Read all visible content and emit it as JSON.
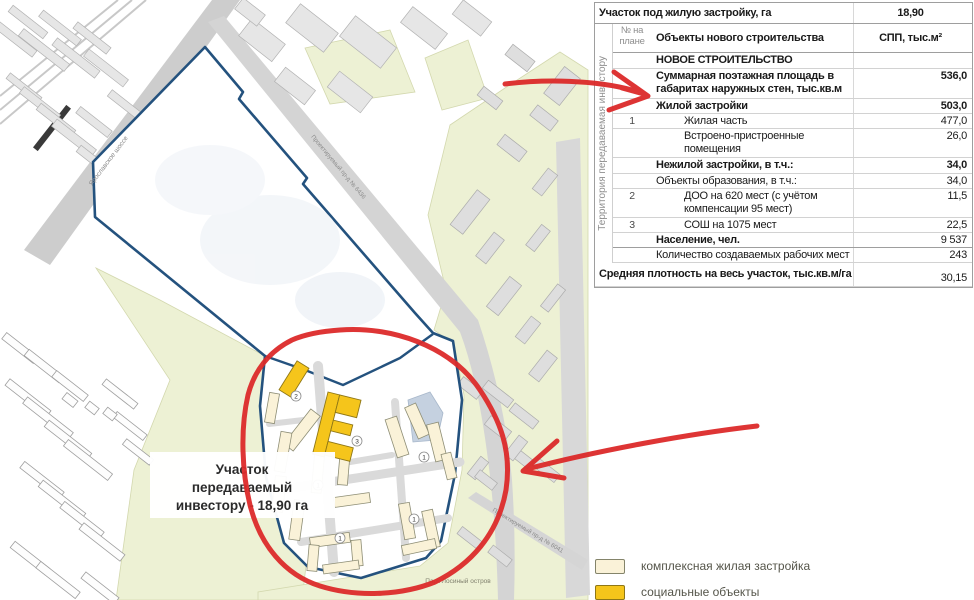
{
  "table": {
    "vertical_label": "Территория передаваемая инвестору",
    "rows": [
      {
        "num": "",
        "label": "Участок под жилую застройку, га",
        "value": "18,90",
        "bold": true,
        "vbold": true,
        "vcenter": true,
        "span": true,
        "hb": true
      },
      {
        "num": "№ на плане",
        "label": "Объекты нового строительства",
        "value": "СПП, тыс.м²",
        "bold": true,
        "vbold": true,
        "vcenter": true,
        "numgray": true,
        "hb": true
      },
      {
        "num": "",
        "label": "НОВОЕ СТРОИТЕЛЬСТВО",
        "value": "",
        "bold": true
      },
      {
        "num": "",
        "label": "Суммарная поэтажная площадь в габаритах наружных стен, тыс.кв.м",
        "value": "536,0",
        "bold": true,
        "vbold": true,
        "tall": true
      },
      {
        "num": "",
        "label": "Жилой застройки",
        "value": "503,0",
        "bold": true,
        "vbold": true
      },
      {
        "num": "1",
        "label": "Жилая часть",
        "value": "477,0",
        "indent": true
      },
      {
        "num": "",
        "label": "Встроено-пристроенные помещения",
        "value": "26,0",
        "indent": true,
        "tall": true
      },
      {
        "num": "",
        "label": "Нежилой застройки, в т.ч.:",
        "value": "34,0",
        "bold": true,
        "vbold": true
      },
      {
        "num": "",
        "label": "Объекты образования, в т.ч.:",
        "value": "34,0"
      },
      {
        "num": "2",
        "label": "ДОО на 620 мест (с учётом компенсации 95 мест)",
        "value": "11,5",
        "indent": true,
        "tall": true
      },
      {
        "num": "3",
        "label": "СОШ на 1075 мест",
        "value": "22,5",
        "indent": true
      },
      {
        "num": "",
        "label": "Население, чел.",
        "value": "9 537",
        "bold": true,
        "hb": true
      },
      {
        "num": "",
        "label": "Количество создаваемых рабочих мест",
        "value": "243"
      },
      {
        "num": "",
        "label": "Средняя плотность на весь участок, тыс.кв.м/га",
        "value": "30,15",
        "bold": true,
        "span": true,
        "vbottom": true
      }
    ]
  },
  "map": {
    "site_label_line1": "Участок",
    "site_label_line2": "передаваемый",
    "site_label_line3": "инвестору - 18,90 га",
    "park_label": "Парк Лосиный остров",
    "road_label_1": "Ярославское шоссе",
    "road_label_2": "Проектируемый пр-д № 6436",
    "road_label_3": "Проектируемый пр-д № 6041",
    "badge_numbers": {
      "b1": "1",
      "b2": "2",
      "b3": "3"
    }
  },
  "legend": {
    "items": [
      {
        "label": "комплексная жилая застройка",
        "color": "#FAF2D8",
        "border": "#84846A"
      },
      {
        "label": "социальные объекты",
        "color": "#F5C51B",
        "border": "#8F7716"
      }
    ]
  },
  "colors": {
    "site_boundary": "#24527E",
    "annotation_red": "#DC2A2A",
    "park_green": "#EDF1D4",
    "pond_blue": "#C5D1E0"
  }
}
